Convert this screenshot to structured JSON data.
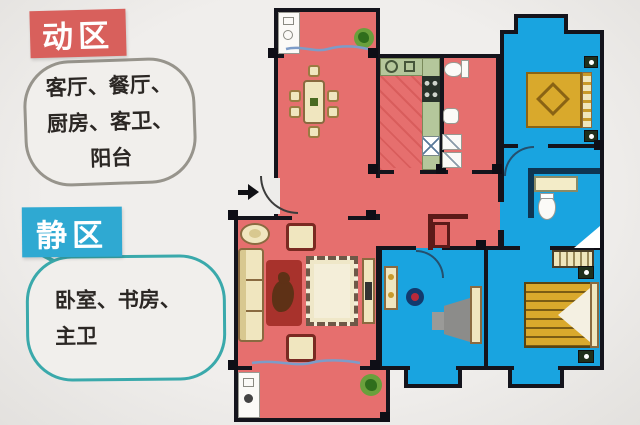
{
  "legend": {
    "active_zone": {
      "title": "动区",
      "box_color": "#d8605c",
      "rooms_lines": [
        "客厅、餐厅、",
        "厨房、客卫、",
        "阳台"
      ]
    },
    "quiet_zone": {
      "title": "静区",
      "box_color": "#2fa9d2",
      "rooms_lines": [
        "卧室、书房、",
        "主卫"
      ]
    }
  },
  "floorplan": {
    "active_zone_color": "#e66f6e",
    "quiet_zone_color": "#19a4e0",
    "wall_color": "#14141c",
    "counter_color": "#b5c79b",
    "bed_color": "#d9a92c"
  }
}
